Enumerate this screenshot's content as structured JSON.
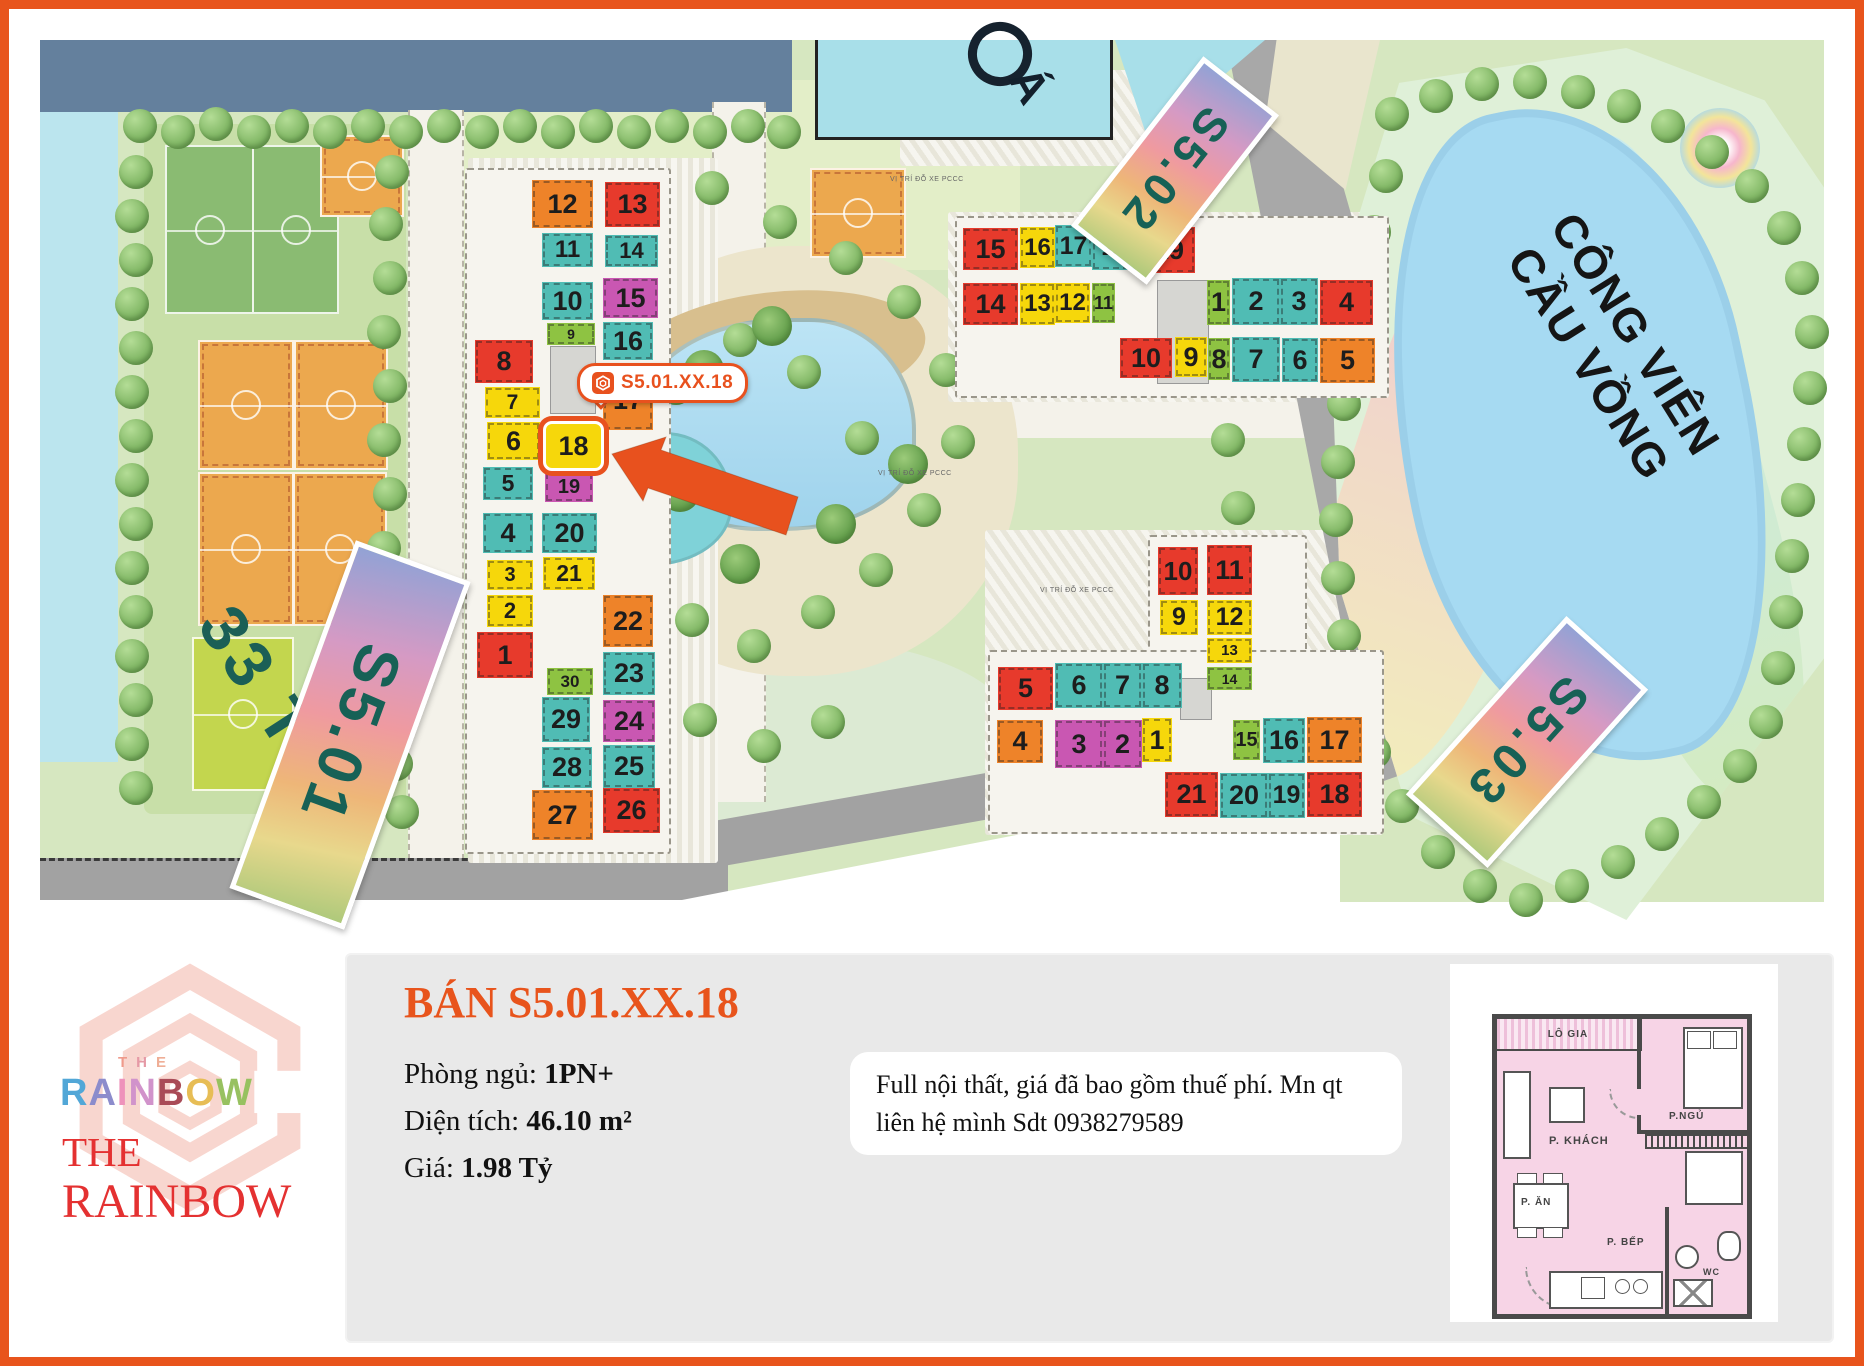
{
  "map": {
    "unit_colors": {
      "orange": "#ee8329",
      "red": "#e73a2c",
      "yellow": "#f6d70b",
      "teal": "#50bcb4",
      "magenta": "#c957b2",
      "green": "#8ec342"
    },
    "highlight": {
      "building": "S5.01",
      "unit": 18
    },
    "buildings": [
      {
        "id": "S5.01",
        "units": [
          [
            12,
            "orange",
            492,
            140,
            61,
            48
          ],
          [
            13,
            "red",
            565,
            142,
            55,
            45
          ],
          [
            11,
            "teal",
            502,
            193,
            51,
            34
          ],
          [
            14,
            "teal",
            565,
            195,
            53,
            32
          ],
          [
            10,
            "teal",
            502,
            242,
            51,
            38
          ],
          [
            15,
            "magenta",
            563,
            238,
            55,
            40
          ],
          [
            9,
            "green",
            507,
            283,
            48,
            22
          ],
          [
            16,
            "teal",
            563,
            282,
            50,
            38
          ],
          [
            8,
            "red",
            435,
            300,
            58,
            43
          ],
          [
            17,
            "orange",
            563,
            330,
            50,
            60
          ],
          [
            7,
            "yellow",
            445,
            347,
            55,
            31
          ],
          [
            6,
            "yellow",
            447,
            382,
            53,
            38
          ],
          [
            18,
            "yellow",
            503,
            381,
            55,
            44
          ],
          [
            5,
            "teal",
            443,
            427,
            50,
            33
          ],
          [
            19,
            "magenta",
            505,
            432,
            48,
            30
          ],
          [
            4,
            "teal",
            443,
            473,
            50,
            40
          ],
          [
            20,
            "teal",
            502,
            473,
            55,
            40
          ],
          [
            3,
            "yellow",
            447,
            520,
            46,
            30
          ],
          [
            21,
            "yellow",
            503,
            517,
            52,
            33
          ],
          [
            2,
            "yellow",
            447,
            555,
            46,
            32
          ],
          [
            22,
            "orange",
            563,
            555,
            50,
            52
          ],
          [
            1,
            "red",
            437,
            592,
            56,
            46
          ],
          [
            23,
            "teal",
            563,
            612,
            52,
            43
          ],
          [
            30,
            "green",
            507,
            628,
            46,
            27
          ],
          [
            29,
            "teal",
            502,
            657,
            48,
            45
          ],
          [
            24,
            "magenta",
            563,
            660,
            52,
            42
          ],
          [
            28,
            "teal",
            502,
            707,
            50,
            41
          ],
          [
            25,
            "teal",
            563,
            705,
            52,
            43
          ],
          [
            27,
            "orange",
            492,
            750,
            61,
            50
          ],
          [
            26,
            "red",
            563,
            748,
            57,
            45
          ]
        ]
      },
      {
        "id": "S5.02",
        "units": [
          [
            15,
            "red",
            923,
            188,
            55,
            42
          ],
          [
            16,
            "yellow",
            980,
            187,
            35,
            41
          ],
          [
            17,
            "teal",
            1015,
            185,
            37,
            42
          ],
          [
            18,
            "teal",
            1052,
            183,
            48,
            47
          ],
          [
            19,
            "red",
            1103,
            187,
            52,
            46
          ],
          [
            14,
            "red",
            923,
            243,
            55,
            42
          ],
          [
            13,
            "yellow",
            980,
            243,
            35,
            42
          ],
          [
            12,
            "yellow",
            1015,
            243,
            35,
            40
          ],
          [
            11,
            "green",
            1052,
            243,
            23,
            40
          ],
          [
            1,
            "green",
            1167,
            240,
            23,
            45
          ],
          [
            2,
            "teal",
            1192,
            238,
            48,
            47
          ],
          [
            3,
            "teal",
            1240,
            238,
            38,
            47
          ],
          [
            4,
            "red",
            1280,
            240,
            53,
            45
          ],
          [
            10,
            "red",
            1080,
            298,
            52,
            40
          ],
          [
            9,
            "yellow",
            1135,
            297,
            32,
            40
          ],
          [
            8,
            "green",
            1168,
            298,
            22,
            42
          ],
          [
            7,
            "teal",
            1192,
            297,
            48,
            45
          ],
          [
            6,
            "teal",
            1242,
            298,
            36,
            44
          ],
          [
            5,
            "orange",
            1280,
            298,
            55,
            45
          ]
        ]
      },
      {
        "id": "S5.03",
        "units": [
          [
            10,
            "red",
            1118,
            507,
            40,
            48
          ],
          [
            11,
            "red",
            1167,
            505,
            45,
            50
          ],
          [
            9,
            "yellow",
            1120,
            560,
            38,
            35
          ],
          [
            12,
            "yellow",
            1167,
            560,
            45,
            35
          ],
          [
            13,
            "yellow",
            1167,
            598,
            45,
            25
          ],
          [
            14,
            "green",
            1167,
            627,
            45,
            23
          ],
          [
            5,
            "red",
            958,
            627,
            55,
            43
          ],
          [
            6,
            "teal",
            1015,
            623,
            48,
            45
          ],
          [
            7,
            "teal",
            1063,
            623,
            39,
            45
          ],
          [
            8,
            "teal",
            1102,
            623,
            40,
            45
          ],
          [
            4,
            "orange",
            957,
            680,
            46,
            43
          ],
          [
            3,
            "magenta",
            1015,
            680,
            48,
            48
          ],
          [
            2,
            "magenta",
            1063,
            680,
            39,
            48
          ],
          [
            1,
            "yellow",
            1102,
            678,
            30,
            44
          ],
          [
            15,
            "green",
            1193,
            680,
            27,
            40
          ],
          [
            16,
            "teal",
            1223,
            678,
            42,
            45
          ],
          [
            17,
            "orange",
            1267,
            677,
            55,
            46
          ],
          [
            21,
            "red",
            1125,
            732,
            53,
            45
          ],
          [
            20,
            "teal",
            1180,
            733,
            48,
            45
          ],
          [
            19,
            "teal",
            1228,
            733,
            37,
            45
          ],
          [
            18,
            "red",
            1267,
            732,
            55,
            45
          ]
        ]
      }
    ],
    "badges": [
      {
        "label": "S5.01"
      },
      {
        "label": "S5.02"
      },
      {
        "label": "S5.03"
      }
    ],
    "area_text": "33 T",
    "park_line1": "CÔNG VIÊN",
    "park_line2": "CẦU VỒNG",
    "pool_text": "Á",
    "road_label": "VỊ TRÍ ĐỖ XE PCCC",
    "callout": {
      "label": "S5.01.XX.18"
    }
  },
  "logo": {
    "the_small": [
      [
        "T",
        "#ef9a8b"
      ],
      [
        "H",
        "#e59aa6"
      ],
      [
        "E",
        "#efae96"
      ]
    ],
    "rainbow": [
      [
        "R",
        "#52a7d7"
      ],
      [
        "A",
        "#8c8ccc"
      ],
      [
        "I",
        "#ee92bb"
      ],
      [
        "N",
        "#d193cb"
      ],
      [
        "B",
        "#a94b57"
      ],
      [
        "O",
        "#e7bd55"
      ],
      [
        "W",
        "#97c160"
      ]
    ],
    "serif_line1": "THE",
    "serif_line2": "RAINBOW",
    "serif_color": "#e43131",
    "mark_color": "#f8d2ca"
  },
  "panel": {
    "title": "BÁN S5.01.XX.18",
    "title_color": "#e8541c",
    "specs": [
      {
        "label": "Phòng ngủ: ",
        "value": "1PN+"
      },
      {
        "label": "Diện tích: ",
        "value": "46.10 m²"
      },
      {
        "label": "Giá: ",
        "value": "1.98 Tỷ"
      }
    ],
    "description": "Full nội thất, giá đã bao gồm thuế phí. Mn qt liên hệ mình Sdt 0938279589"
  },
  "floorplan": {
    "rooms": {
      "balcony": "LÔ GIA",
      "living": "P. KHÁCH",
      "bedroom": "P.NGỦ",
      "dining": "P. ĂN",
      "kitchen": "P. BẾP",
      "wc": "WC"
    }
  }
}
